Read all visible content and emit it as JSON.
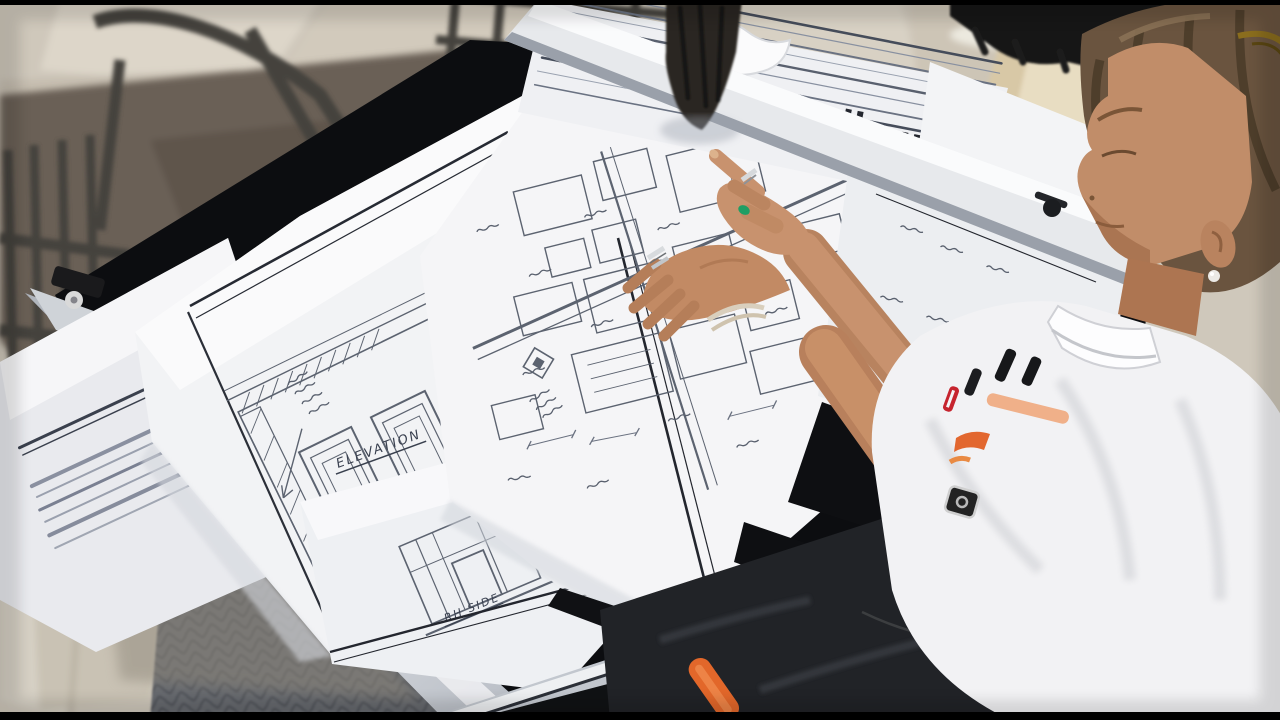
{
  "scene": {
    "summary": "Overhead outdoor photo of a woman at a tilted drafting table on a stone patio, pointing with both hands at hand-drawn architectural sketches on overlapping sheets of tracing paper",
    "setting": "flagstone patio with metal lattice chairs, rubber floor mats, beige pillar and black cover in background",
    "objects": [
      {
        "name": "drafting-table",
        "color": "#0c0d10",
        "rails": "#dfe2e6"
      },
      {
        "name": "tracing-paper-sheets",
        "color": "#f3f3f5",
        "ink_border": "#23262e",
        "pencil": "#5c6370"
      },
      {
        "name": "metal-patio-chairs",
        "color": "#46443e"
      },
      {
        "name": "stone-floor",
        "color": "#cfc8bb"
      },
      {
        "name": "chair-mat",
        "color": "#6b6157"
      },
      {
        "name": "rubber-floor-mat",
        "color": "#73767c"
      },
      {
        "name": "drafting-brush",
        "color": "#2b2723"
      },
      {
        "name": "woman",
        "hair": "#6a543f",
        "skin": "#c18d69",
        "shirt": "#f2f2f4",
        "pants": "#212327"
      },
      {
        "name": "sunglasses",
        "color": "#8a6d1d"
      },
      {
        "name": "pearl-earring",
        "color": "#eceae6"
      },
      {
        "name": "green-nail-polish",
        "color": "#1f9e64"
      },
      {
        "name": "silver-rings",
        "color": "#d6d9dc"
      },
      {
        "name": "wrist-rubber-band",
        "color": "#d9cfbd"
      },
      {
        "name": "marker-pens",
        "colors": [
          "#17181a",
          "#c6242e"
        ]
      },
      {
        "name": "shirt-logo",
        "color": "#e2672f"
      },
      {
        "name": "orange-handle",
        "color": "#e2672a"
      },
      {
        "name": "pillar",
        "color": "#e8ddc2"
      },
      {
        "name": "black-cover",
        "color": "#141414"
      }
    ]
  },
  "annotations": {
    "elevation_label": "ELEVATION",
    "side_label": "RH SIDE"
  },
  "palette": {
    "letterbox": "#000000",
    "stone_light": "#e5e0d6",
    "stone_dark": "#b9b1a4",
    "paper_shadow": "#d5d8de",
    "table_black": "#0c0d10",
    "rail_aluminum": "#c6cad1"
  }
}
